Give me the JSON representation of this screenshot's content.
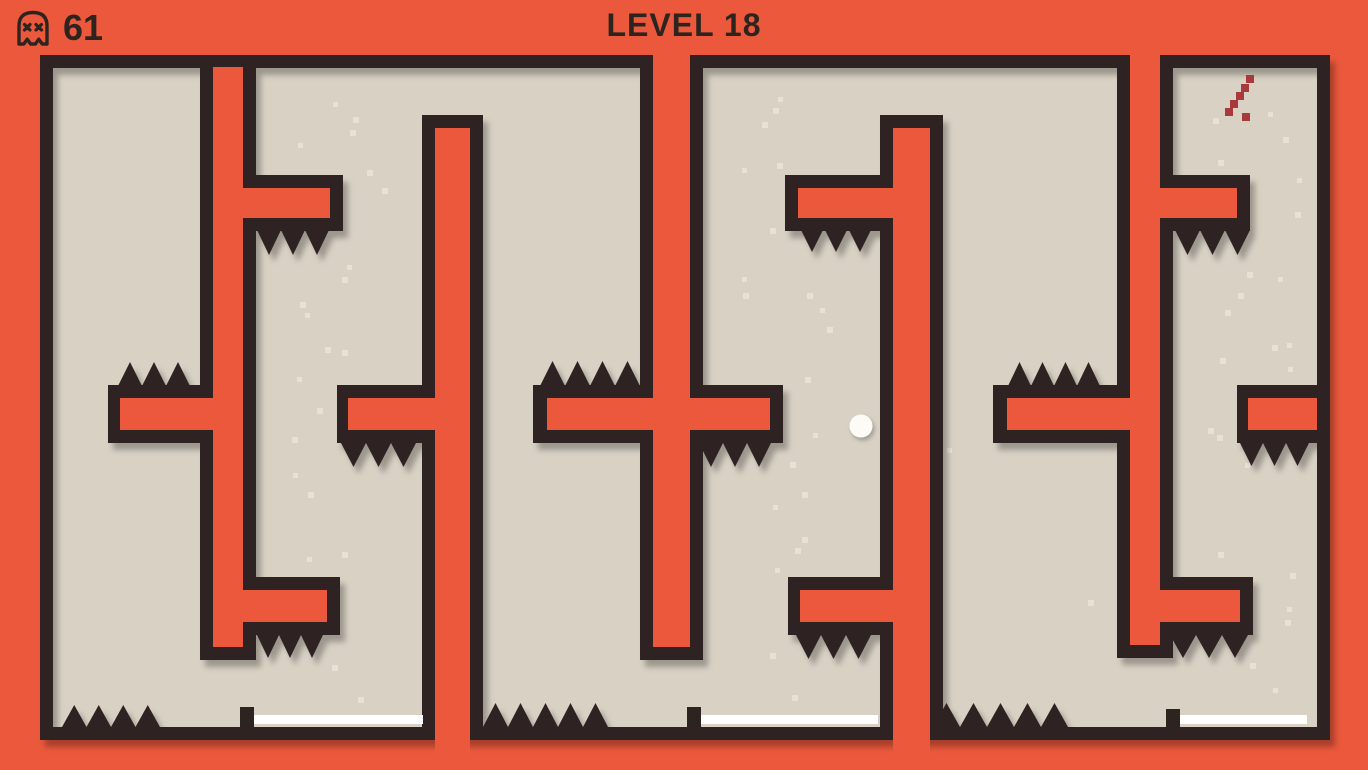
{
  "hud": {
    "title": "LEVEL 18",
    "deaths": "61",
    "death_icon": "skull-ghost-icon"
  },
  "colors": {
    "background_orange": "#EB583B",
    "wall_dark": "#2D2420",
    "floor_beige": "#D8D1C4",
    "finish_line_white": "#FFFFFF",
    "ball_white": "#FCFBF5",
    "trail_red": "#A93A3C",
    "speckle": "#E9E3D6",
    "text_dark": "#2D2420"
  },
  "game": {
    "ball": {
      "cx": 861,
      "cy": 426,
      "r": 11.5
    },
    "trail_dot_size": 8,
    "trail": [
      [
        1246,
        75
      ],
      [
        1241,
        84
      ],
      [
        1236,
        92
      ],
      [
        1230,
        100
      ],
      [
        1225,
        108
      ],
      [
        1242,
        113
      ]
    ],
    "finish_lines": [
      {
        "x": 253,
        "y": 715,
        "w": 170,
        "h": 9
      },
      {
        "x": 700,
        "y": 715,
        "w": 178,
        "h": 9
      },
      {
        "x": 1180,
        "y": 715,
        "w": 127,
        "h": 9
      }
    ],
    "line_posts": [
      {
        "x": 240,
        "y": 707,
        "w": 14,
        "h": 21
      },
      {
        "x": 687,
        "y": 707,
        "w": 14,
        "h": 21
      },
      {
        "x": 1166,
        "y": 709,
        "w": 14,
        "h": 19
      }
    ],
    "spike_groups": [
      {
        "name": "spikes-under-top-arm-room-b",
        "x": 257,
        "y": 230,
        "count": 3,
        "w": 24,
        "h": 25,
        "dir": "down"
      },
      {
        "name": "spikes-under-top-arm-room-c",
        "x": 800,
        "y": 228,
        "count": 3,
        "w": 24,
        "h": 24,
        "dir": "down"
      },
      {
        "name": "spikes-under-top-arm-room-d",
        "x": 1175,
        "y": 230,
        "count": 3,
        "w": 25,
        "h": 25,
        "dir": "down"
      },
      {
        "name": "spikes-on-mid-ledge-room-a",
        "x": 118,
        "y": 362,
        "count": 3,
        "w": 24,
        "h": 24,
        "dir": "up"
      },
      {
        "name": "spikes-on-mid-ledge-left-of-channel-bc",
        "x": 540,
        "y": 361,
        "count": 4,
        "w": 25,
        "h": 25,
        "dir": "up"
      },
      {
        "name": "spikes-on-mid-ledge-left-of-channel-cd",
        "x": 1008,
        "y": 362,
        "count": 4,
        "w": 23,
        "h": 24,
        "dir": "up"
      },
      {
        "name": "spikes-under-mid-arm-bar-b",
        "x": 341,
        "y": 443,
        "count": 3,
        "w": 25,
        "h": 24,
        "dir": "down"
      },
      {
        "name": "spikes-under-mid-arm-right-of-channel-bc",
        "x": 699,
        "y": 443,
        "count": 3,
        "w": 24,
        "h": 24,
        "dir": "down"
      },
      {
        "name": "spikes-under-mid-arm-room-d",
        "x": 1240,
        "y": 443,
        "count": 3,
        "w": 23,
        "h": 23,
        "dir": "down"
      },
      {
        "name": "spikes-under-bottom-arm-channel-ab",
        "x": 257,
        "y": 635,
        "count": 3,
        "w": 22,
        "h": 23,
        "dir": "down"
      },
      {
        "name": "spikes-under-bottom-arm-bar-c",
        "x": 796,
        "y": 635,
        "count": 3,
        "w": 25,
        "h": 24,
        "dir": "down"
      },
      {
        "name": "spikes-under-bottom-arm-channel-cd",
        "x": 1170,
        "y": 635,
        "count": 3,
        "w": 26,
        "h": 23,
        "dir": "down"
      },
      {
        "name": "floor-spikes-room-a",
        "x": 62,
        "y": 705,
        "count": 4,
        "w": 24.5,
        "h": 22,
        "dir": "up"
      },
      {
        "name": "floor-spikes-room-b",
        "x": 483,
        "y": 703,
        "count": 5,
        "w": 25,
        "h": 24,
        "dir": "up"
      },
      {
        "name": "floor-spikes-room-c",
        "x": 933,
        "y": 703,
        "count": 5,
        "w": 27,
        "h": 24,
        "dir": "up"
      }
    ],
    "speckle_size": 6,
    "speckles": [
      [
        333,
        102
      ],
      [
        353,
        117
      ],
      [
        350,
        130
      ],
      [
        298,
        143
      ],
      [
        367,
        170
      ],
      [
        382,
        188
      ],
      [
        347,
        265
      ],
      [
        342,
        277
      ],
      [
        300,
        302
      ],
      [
        305,
        313
      ],
      [
        325,
        347
      ],
      [
        342,
        350
      ],
      [
        297,
        377
      ],
      [
        317,
        408
      ],
      [
        292,
        437
      ],
      [
        293,
        473
      ],
      [
        308,
        492
      ],
      [
        342,
        552
      ],
      [
        307,
        557
      ],
      [
        332,
        665
      ],
      [
        358,
        697
      ],
      [
        778,
        97
      ],
      [
        773,
        108
      ],
      [
        762,
        122
      ],
      [
        742,
        168
      ],
      [
        777,
        163
      ],
      [
        770,
        228
      ],
      [
        742,
        277
      ],
      [
        743,
        293
      ],
      [
        807,
        293
      ],
      [
        820,
        308
      ],
      [
        827,
        327
      ],
      [
        805,
        377
      ],
      [
        813,
        433
      ],
      [
        790,
        462
      ],
      [
        802,
        492
      ],
      [
        773,
        505
      ],
      [
        802,
        537
      ],
      [
        795,
        548
      ],
      [
        775,
        568
      ],
      [
        770,
        653
      ],
      [
        792,
        695
      ],
      [
        947,
        448
      ],
      [
        1088,
        600
      ],
      [
        1213,
        118
      ],
      [
        1268,
        112
      ],
      [
        1283,
        137
      ],
      [
        1218,
        160
      ],
      [
        1297,
        178
      ],
      [
        1295,
        212
      ],
      [
        1247,
        272
      ],
      [
        1278,
        277
      ],
      [
        1238,
        293
      ],
      [
        1225,
        310
      ],
      [
        1287,
        343
      ],
      [
        1272,
        345
      ],
      [
        1220,
        358
      ],
      [
        1288,
        367
      ],
      [
        1208,
        428
      ],
      [
        1217,
        435
      ],
      [
        1245,
        463
      ],
      [
        1218,
        552
      ],
      [
        1290,
        573
      ],
      [
        1287,
        607
      ],
      [
        1285,
        620
      ],
      [
        1250,
        663
      ],
      [
        1273,
        688
      ]
    ]
  }
}
